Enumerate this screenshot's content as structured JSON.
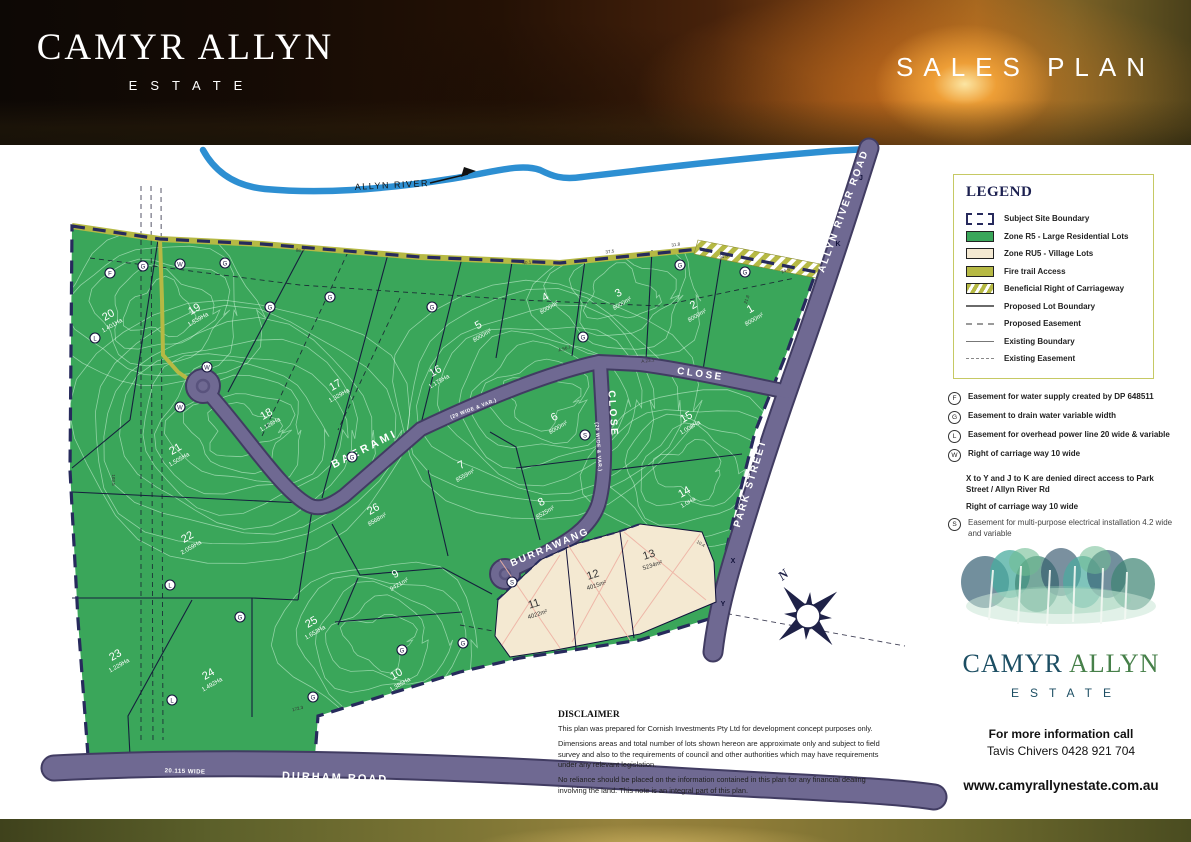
{
  "header": {
    "estate_name": "CAMYR ALLYN",
    "estate_sub": "ESTATE",
    "plan_title": "SALES PLAN"
  },
  "map": {
    "river_label": "ALLYN RIVER",
    "north_label": "N",
    "colors": {
      "lot_green": "#3aa65a",
      "village_cream": "#f4e9d2",
      "road": "#6f6992",
      "road_casing": "#413c62",
      "boundary_navy": "#272a5c",
      "fire_trail_olive": "#b6b944",
      "river_blue": "#2d8fd2"
    },
    "road_labels": [
      {
        "id": "baerami",
        "text": "BAERAMI",
        "x": 366,
        "y": 452,
        "rot": -27,
        "size": 11,
        "ls": 3
      },
      {
        "id": "baerami-close",
        "text": "CLOSE",
        "x": 700,
        "y": 377,
        "rot": 8,
        "size": 10,
        "ls": 2.5
      },
      {
        "id": "baerami-width",
        "text": "(20 WIDE & VAR.)",
        "x": 474,
        "y": 410,
        "rot": -21,
        "size": 5,
        "ls": 0.5
      },
      {
        "id": "burrawang",
        "text": "BURRAWANG",
        "x": 551,
        "y": 550,
        "rot": -23,
        "size": 10,
        "ls": 2
      },
      {
        "id": "burrawang-close",
        "text": "CLOSE",
        "x": 610,
        "y": 414,
        "rot": 86,
        "size": 10,
        "ls": 2.5
      },
      {
        "id": "burrawang-width",
        "text": "(20 WIDE & VAR.)",
        "x": 597,
        "y": 447,
        "rot": 86,
        "size": 5,
        "ls": 0.5
      },
      {
        "id": "park-street",
        "text": "PARK STREET",
        "x": 753,
        "y": 484,
        "rot": -73,
        "size": 10,
        "ls": 2
      },
      {
        "id": "allyn-river-road",
        "text": "ALLYN RIVER ROAD",
        "x": 846,
        "y": 212,
        "rot": -70,
        "size": 10,
        "ls": 2
      },
      {
        "id": "durham-road",
        "text": "DURHAM ROAD",
        "x": 335,
        "y": 781,
        "rot": 2,
        "size": 11,
        "ls": 2
      },
      {
        "id": "durham-width",
        "text": "20.115 WIDE",
        "x": 185,
        "y": 773,
        "rot": 2,
        "size": 6,
        "ls": 0.5
      }
    ],
    "lots": [
      {
        "n": "1",
        "area": "8000m²",
        "x": 752,
        "y": 312,
        "rot": -30
      },
      {
        "n": "2",
        "area": "8000m²",
        "x": 695,
        "y": 308,
        "rot": -30
      },
      {
        "n": "3",
        "area": "8000m²",
        "x": 620,
        "y": 296,
        "rot": -30
      },
      {
        "n": "4",
        "area": "8000m²",
        "x": 547,
        "y": 300,
        "rot": -30
      },
      {
        "n": "5",
        "area": "8000m²",
        "x": 480,
        "y": 328,
        "rot": -30
      },
      {
        "n": "6",
        "area": "8000m²",
        "x": 556,
        "y": 420,
        "rot": -30
      },
      {
        "n": "7",
        "area": "8559m²",
        "x": 463,
        "y": 468,
        "rot": -30
      },
      {
        "n": "8",
        "area": "8525m²",
        "x": 543,
        "y": 505,
        "rot": -30
      },
      {
        "n": "9",
        "area": "9421m²",
        "x": 397,
        "y": 577,
        "rot": -30
      },
      {
        "n": "10",
        "area": "1.385Ha",
        "x": 398,
        "y": 677,
        "rot": -30
      },
      {
        "n": "14",
        "area": "1.0Ha",
        "x": 686,
        "y": 495,
        "rot": -30
      },
      {
        "n": "15",
        "area": "1.008Ha",
        "x": 688,
        "y": 420,
        "rot": -30
      },
      {
        "n": "16",
        "area": "1.175Ha",
        "x": 437,
        "y": 374,
        "rot": -30
      },
      {
        "n": "17",
        "area": "1.329Ha",
        "x": 337,
        "y": 388,
        "rot": -30
      },
      {
        "n": "18",
        "area": "1.128Ha",
        "x": 268,
        "y": 417,
        "rot": -30
      },
      {
        "n": "19",
        "area": "1.539Ha",
        "x": 196,
        "y": 312,
        "rot": -30
      },
      {
        "n": "20",
        "area": "1.401Ha",
        "x": 110,
        "y": 318,
        "rot": -30
      },
      {
        "n": "21",
        "area": "1.505Ha",
        "x": 177,
        "y": 452,
        "rot": -30
      },
      {
        "n": "22",
        "area": "2.059Ha",
        "x": 189,
        "y": 540,
        "rot": -30
      },
      {
        "n": "23",
        "area": "1.229Ha",
        "x": 117,
        "y": 658,
        "rot": -30
      },
      {
        "n": "24",
        "area": "1.492Ha",
        "x": 210,
        "y": 677,
        "rot": -30
      },
      {
        "n": "25",
        "area": "1.653Ha",
        "x": 313,
        "y": 625,
        "rot": -30
      },
      {
        "n": "26",
        "area": "8568m²",
        "x": 375,
        "y": 512,
        "rot": -30
      }
    ],
    "village_lots": [
      {
        "n": "11",
        "area": "4022m²",
        "x": 535,
        "y": 607,
        "rot": -18
      },
      {
        "n": "12",
        "area": "4015m²",
        "x": 594,
        "y": 578,
        "rot": -18
      },
      {
        "n": "13",
        "area": "5234m²",
        "x": 650,
        "y": 558,
        "rot": -18
      }
    ],
    "markers": [
      {
        "l": "G",
        "x": 143,
        "y": 266
      },
      {
        "l": "F",
        "x": 110,
        "y": 273
      },
      {
        "l": "G",
        "x": 225,
        "y": 263
      },
      {
        "l": "W",
        "x": 180,
        "y": 264
      },
      {
        "l": "G",
        "x": 270,
        "y": 307
      },
      {
        "l": "G",
        "x": 330,
        "y": 297
      },
      {
        "l": "G",
        "x": 432,
        "y": 307
      },
      {
        "l": "G",
        "x": 680,
        "y": 265
      },
      {
        "l": "G",
        "x": 745,
        "y": 272
      },
      {
        "l": "W",
        "x": 207,
        "y": 367
      },
      {
        "l": "L",
        "x": 95,
        "y": 338
      },
      {
        "l": "W",
        "x": 180,
        "y": 407
      },
      {
        "l": "G",
        "x": 352,
        "y": 457
      },
      {
        "l": "S",
        "x": 585,
        "y": 435
      },
      {
        "l": "G",
        "x": 583,
        "y": 337
      },
      {
        "l": "L",
        "x": 170,
        "y": 585
      },
      {
        "l": "G",
        "x": 240,
        "y": 617
      },
      {
        "l": "G",
        "x": 313,
        "y": 697
      },
      {
        "l": "G",
        "x": 402,
        "y": 650
      },
      {
        "l": "G",
        "x": 463,
        "y": 643
      },
      {
        "l": "L",
        "x": 172,
        "y": 700
      },
      {
        "l": "S",
        "x": 512,
        "y": 582
      }
    ],
    "access_letters": [
      {
        "l": "K",
        "x": 838,
        "y": 246
      },
      {
        "l": "J",
        "x": 861,
        "y": 180
      },
      {
        "l": "X",
        "x": 733,
        "y": 563
      },
      {
        "l": "Y",
        "x": 723,
        "y": 606
      }
    ],
    "dims": [
      {
        "t": "40.1",
        "x": 527,
        "y": 264,
        "r": -6
      },
      {
        "t": "37.5",
        "x": 610,
        "y": 253,
        "r": -6
      },
      {
        "t": "31.8",
        "x": 676,
        "y": 246,
        "r": -8
      },
      {
        "t": "34.8",
        "x": 724,
        "y": 258,
        "r": -14
      },
      {
        "t": "24.5",
        "x": 786,
        "y": 272,
        "r": -20
      },
      {
        "t": "86.7",
        "x": 300,
        "y": 252,
        "r": 8
      },
      {
        "t": "A.56.7",
        "x": 565,
        "y": 350,
        "r": -16
      },
      {
        "t": "A.23.1",
        "x": 648,
        "y": 362,
        "r": -8
      },
      {
        "t": "172.3",
        "x": 298,
        "y": 710,
        "r": -14
      },
      {
        "t": "103.5",
        "x": 112,
        "y": 480,
        "r": 90
      },
      {
        "t": "21.8",
        "x": 748,
        "y": 300,
        "r": -70
      },
      {
        "t": "10.4",
        "x": 700,
        "y": 545,
        "r": 30
      }
    ]
  },
  "legend": {
    "title": "LEGEND",
    "items": [
      {
        "swatch": "boundary",
        "label": "Subject Site Boundary"
      },
      {
        "swatch": "green",
        "label": "Zone R5 - Large Residential Lots"
      },
      {
        "swatch": "cream",
        "label": "Zone RU5 - Village Lots"
      },
      {
        "swatch": "olive",
        "label": "Fire trail Access"
      },
      {
        "swatch": "hatch",
        "label": "Beneficial Right of Carriageway"
      },
      {
        "swatch": "line-solid",
        "label": "Proposed Lot Boundary"
      },
      {
        "swatch": "line-dash",
        "label": "Proposed Easement"
      },
      {
        "swatch": "line-thin",
        "label": "Existing Boundary"
      },
      {
        "swatch": "line-thindash",
        "label": "Existing Easement"
      }
    ]
  },
  "notes": {
    "rows": [
      {
        "icon": "F",
        "text": "Easement for water supply created by DP 648511",
        "style": "bold"
      },
      {
        "icon": "G",
        "text": "Easement to drain water variable width",
        "style": "bold"
      },
      {
        "icon": "L",
        "text": "Easement for overhead power line 20 wide & variable",
        "style": "bold"
      },
      {
        "icon": "W",
        "text": "Right of carriage way 10 wide",
        "style": "bold"
      },
      {
        "icon": "",
        "text": "X to Y and J to K are denied direct access to Park Street / Allyn River Rd",
        "style": "bold-gap"
      },
      {
        "icon": "",
        "text": "Right of carriage way 10 wide",
        "style": "bold"
      },
      {
        "icon": "S",
        "text": "Easement for multi-purpose electrical installation 4.2 wide and variable",
        "style": "plain"
      }
    ]
  },
  "branding": {
    "name_teal": "CAMYR",
    "name_green": "ALLYN",
    "sub": "ESTATE",
    "info_line1": "For more information call",
    "info_line2": "Tavis Chivers 0428 921 704",
    "website": "www.camyrallynestate.com.au"
  },
  "disclaimer": {
    "title": "DISCLAIMER",
    "paragraphs": [
      "This plan was prepared for Cornish Investments Pty Ltd for development concept purposes only.",
      "Dimensions areas and total number of lots shown hereon are approximate only and subject to field survey and also to the requirements of council and other authorities which may have requirements under any relevant legislation.",
      "No reliance should be placed on the information contained in this plan for any financial dealing involving the land. This note is an integral part of this plan."
    ]
  }
}
